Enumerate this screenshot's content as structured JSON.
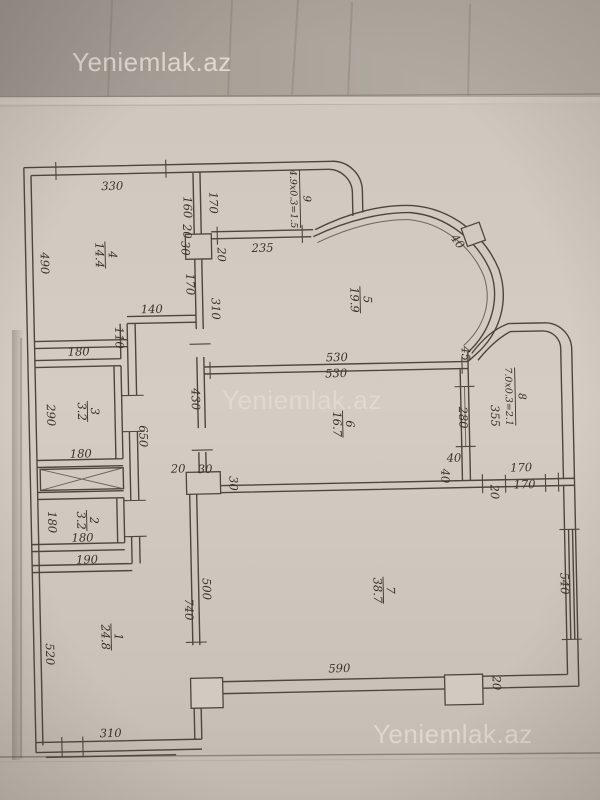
{
  "watermark": {
    "text": "Yeniemlak.az"
  },
  "plan": {
    "rooms": [
      {
        "num": "1",
        "area": "24.8",
        "x": 108,
        "y": 633
      },
      {
        "num": "2",
        "area": "3.2",
        "x": 86,
        "y": 516
      },
      {
        "num": "3",
        "area": "3.2",
        "x": 89,
        "y": 407
      },
      {
        "num": "4",
        "area": "14.4",
        "x": 110,
        "y": 251
      },
      {
        "num": "5",
        "area": "19.9",
        "x": 364,
        "y": 301
      },
      {
        "num": "6",
        "area": "16.7",
        "x": 344,
        "y": 425
      },
      {
        "num": "7",
        "area": "38.7",
        "x": 381,
        "y": 592
      },
      {
        "num": "8",
        "area": "7.0x0.3=2.1",
        "x": 517,
        "y": 401
      },
      {
        "num": "9",
        "area": "4.9x0.3=1.5",
        "x": 306,
        "y": 199
      }
    ],
    "dimensions": [
      {
        "t": "330",
        "x": 118,
        "y": 186,
        "s": 14
      },
      {
        "t": "490",
        "x": 45,
        "y": 258,
        "r": 90
      },
      {
        "t": "160",
        "x": 189,
        "y": 205,
        "r": 90
      },
      {
        "t": "170",
        "x": 215,
        "y": 201,
        "r": 90
      },
      {
        "t": "20",
        "x": 188,
        "y": 229,
        "r": 90
      },
      {
        "t": "30",
        "x": 186,
        "y": 246,
        "r": 90
      },
      {
        "t": "20",
        "x": 222,
        "y": 253,
        "r": 90
      },
      {
        "t": "235",
        "x": 267,
        "y": 251,
        "s": 13
      },
      {
        "t": "170",
        "x": 190,
        "y": 282,
        "r": 90
      },
      {
        "t": "310",
        "x": 215,
        "y": 307,
        "r": 90
      },
      {
        "t": "140",
        "x": 155,
        "y": 310
      },
      {
        "t": "110",
        "x": 118,
        "y": 334,
        "r": 90
      },
      {
        "t": "180",
        "x": 81,
        "y": 351
      },
      {
        "t": "290",
        "x": 48,
        "y": 410,
        "r": 90
      },
      {
        "t": "180",
        "x": 81,
        "y": 453
      },
      {
        "t": "650",
        "x": 140,
        "y": 433,
        "r": 90
      },
      {
        "t": "430",
        "x": 193,
        "y": 397,
        "r": 90
      },
      {
        "t": "530",
        "x": 339,
        "y": 362,
        "s": 12
      },
      {
        "t": "530",
        "x": 338,
        "y": 378,
        "s": 12
      },
      {
        "t": "280",
        "x": 460,
        "y": 421,
        "r": 90
      },
      {
        "t": "355",
        "x": 492,
        "y": 420,
        "r": 90
      },
      {
        "t": "45",
        "x": 464,
        "y": 357,
        "r": 90
      },
      {
        "t": "40",
        "x": 459,
        "y": 247,
        "r": 55
      },
      {
        "t": "180",
        "x": 47,
        "y": 517,
        "r": 90
      },
      {
        "t": "180",
        "x": 81,
        "y": 537
      },
      {
        "t": "190",
        "x": 85,
        "y": 559,
        "s": 12
      },
      {
        "t": "520",
        "x": 42,
        "y": 649,
        "r": 90
      },
      {
        "t": "500",
        "x": 200,
        "y": 587,
        "r": 90
      },
      {
        "t": "740",
        "x": 182,
        "y": 607,
        "r": 90
      },
      {
        "t": "310",
        "x": 105,
        "y": 733,
        "s": 14
      },
      {
        "t": "590",
        "x": 335,
        "y": 673,
        "s": 14
      },
      {
        "t": "20",
        "x": 488,
        "y": 687,
        "r": 90
      },
      {
        "t": "540",
        "x": 558,
        "y": 589,
        "r": 90
      },
      {
        "t": "170",
        "x": 521,
        "y": 476,
        "s": 12
      },
      {
        "t": "170",
        "x": 524,
        "y": 493,
        "s": 12
      },
      {
        "t": "20",
        "x": 490,
        "y": 496,
        "r": 90
      },
      {
        "t": "40",
        "x": 454,
        "y": 465
      },
      {
        "t": "40",
        "x": 441,
        "y": 479,
        "r": 90
      },
      {
        "t": "20",
        "x": 178,
        "y": 470
      },
      {
        "t": "30",
        "x": 205,
        "y": 471
      },
      {
        "t": "30",
        "x": 229,
        "y": 482,
        "r": 90
      }
    ]
  }
}
